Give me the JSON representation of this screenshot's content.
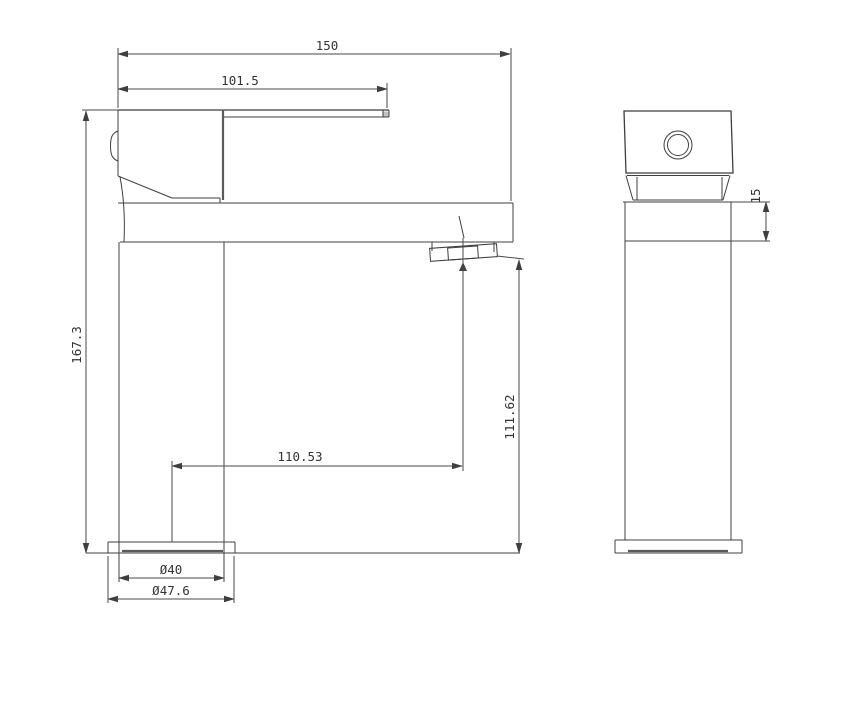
{
  "colors": {
    "line": "#3f3f3f",
    "background": "#ffffff",
    "text": "#333333"
  },
  "dimensions": {
    "overall_length": "150",
    "spout_length": "101.5",
    "overall_height": "167.3",
    "spout_center_offset": "110.53",
    "outlet_height": "111.62",
    "body_diameter": "Ø40",
    "base_diameter": "Ø47.6",
    "collar_height": "15"
  }
}
